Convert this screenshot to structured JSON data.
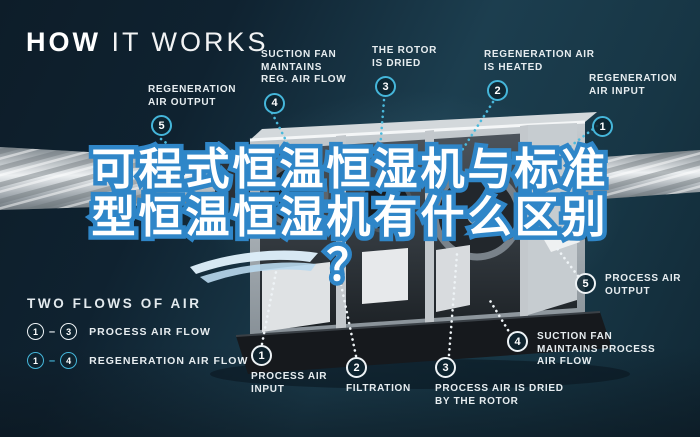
{
  "title": {
    "word_bold": "HOW",
    "word_light": "IT WORKS"
  },
  "headline": {
    "line1": "可程式恒温恒湿机与标准",
    "line2": "型恒温恒湿机有什么区别",
    "line3": "？"
  },
  "callouts": [
    {
      "num": "5",
      "label": "REGENERATION\nAIR OUTPUT",
      "flow": "regeneration"
    },
    {
      "num": "4",
      "label": "SUCTION FAN\nMAINTAINS\nREG. AIR FLOW",
      "flow": "regeneration"
    },
    {
      "num": "3",
      "label": "THE ROTOR\nIS DRIED",
      "flow": "regeneration"
    },
    {
      "num": "2",
      "label": "REGENERATION AIR\nIS HEATED",
      "flow": "regeneration"
    },
    {
      "num": "1",
      "label": "REGENERATION\nAIR INPUT",
      "flow": "regeneration"
    },
    {
      "num": "5",
      "label": "PROCESS AIR\nOUTPUT",
      "flow": "process"
    },
    {
      "num": "4",
      "label": "SUCTION FAN\nMAINTAINS PROCESS\nAIR FLOW",
      "flow": "process"
    },
    {
      "num": "3",
      "label": "PROCESS AIR IS DRIED\nBY THE ROTOR",
      "flow": "process"
    },
    {
      "num": "2",
      "label": "FILTRATION",
      "flow": "process"
    },
    {
      "num": "1",
      "label": "PROCESS AIR\nINPUT",
      "flow": "process"
    }
  ],
  "legend": {
    "title": "TWO FLOWS OF AIR",
    "rows": [
      {
        "from": "1",
        "dash": "–",
        "to": "3",
        "label": "PROCESS AIR FLOW",
        "flow": "process"
      },
      {
        "from": "1",
        "dash": "–",
        "to": "4",
        "label": "REGENERATION AIR FLOW",
        "flow": "regeneration"
      }
    ]
  },
  "colors": {
    "background": "#16313f",
    "accent_cyan": "#45b6da",
    "process_white": "#eef3f6",
    "badge_fill": "#0d2430",
    "headline_fill": "#ffffff",
    "headline_stroke": "#2f86c8"
  }
}
